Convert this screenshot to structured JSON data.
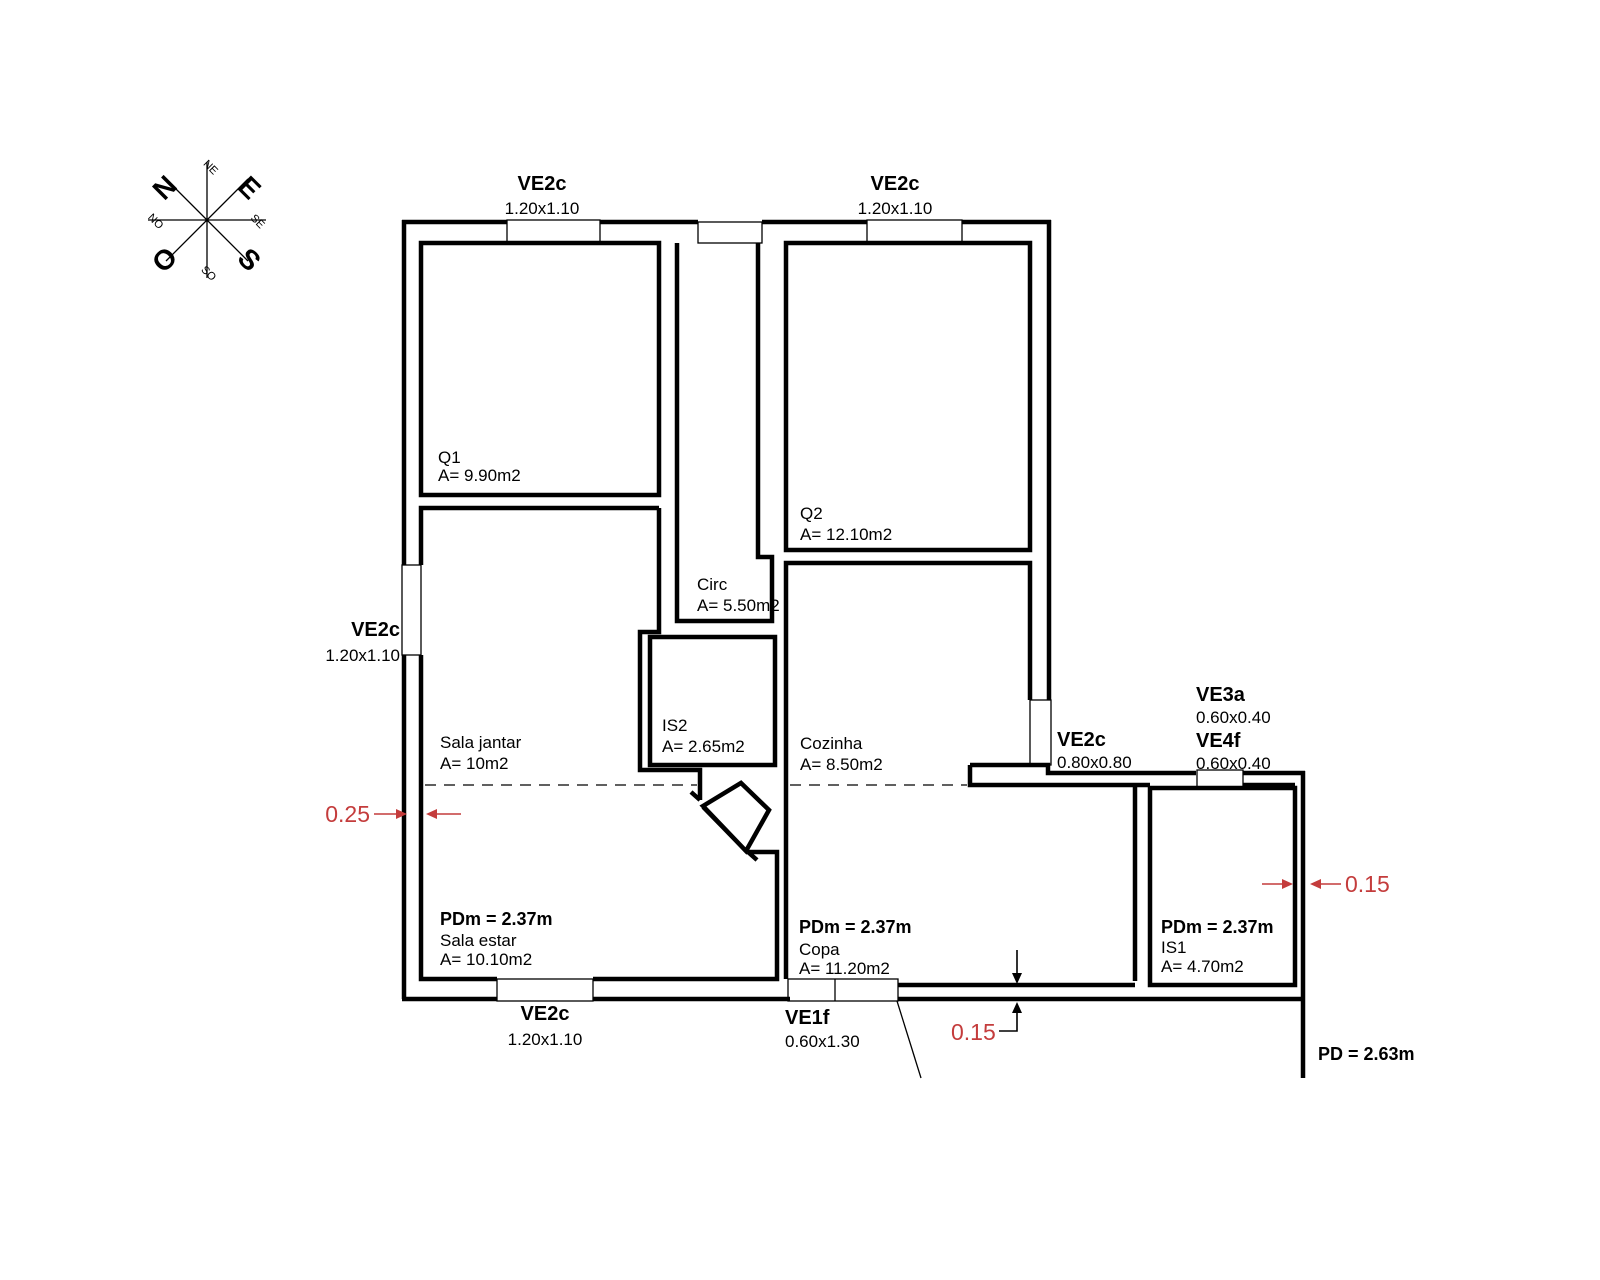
{
  "compass": {
    "n": "N",
    "e": "E",
    "o": "O",
    "s": "S",
    "ne": "NE",
    "se": "SE",
    "so": "SO",
    "no": "NO"
  },
  "windows": {
    "top_left": {
      "code": "VE2c",
      "size": "1.20x1.10"
    },
    "top_right": {
      "code": "VE2c",
      "size": "1.20x1.10"
    },
    "left": {
      "code": "VE2c",
      "size": "1.20x1.10"
    },
    "bottom": {
      "code": "VE2c",
      "size": "1.20x1.10"
    },
    "entry": {
      "code": "VE1f",
      "size": "0.60x1.30"
    },
    "right": {
      "code": "VE2c",
      "size": "0.80x0.80"
    },
    "ve3a": {
      "code": "VE3a",
      "size": "0.60x0.40"
    },
    "ve4f": {
      "code": "VE4f",
      "size": "0.60x0.40"
    }
  },
  "rooms": {
    "q1": {
      "name": "Q1",
      "area": "A= 9.90m2"
    },
    "q2": {
      "name": "Q2",
      "area": "A= 12.10m2"
    },
    "circ": {
      "name": "Circ",
      "area": "A= 5.50m2"
    },
    "is2": {
      "name": "IS2",
      "area": "A= 2.65m2"
    },
    "sala_jantar": {
      "name": "Sala jantar",
      "area": "A= 10m2"
    },
    "sala_estar": {
      "pdm": "PDm = 2.37m",
      "name": "Sala estar",
      "area": "A= 10.10m2"
    },
    "cozinha": {
      "name": "Cozinha",
      "area": "A= 8.50m2"
    },
    "copa": {
      "pdm": "PDm = 2.37m",
      "name": "Copa",
      "area": "A= 11.20m2"
    },
    "is1": {
      "pdm": "PDm = 2.37m",
      "name": "IS1",
      "area": "A= 4.70m2"
    }
  },
  "dimensions": {
    "left_wall": "0.25",
    "right_wall": "0.15",
    "bottom_wall": "0.15"
  },
  "notes": {
    "ceiling_height": "PD = 2.63m"
  },
  "colors": {
    "line": "#000000",
    "dimension_red": "#c43c3c",
    "background": "#ffffff"
  }
}
